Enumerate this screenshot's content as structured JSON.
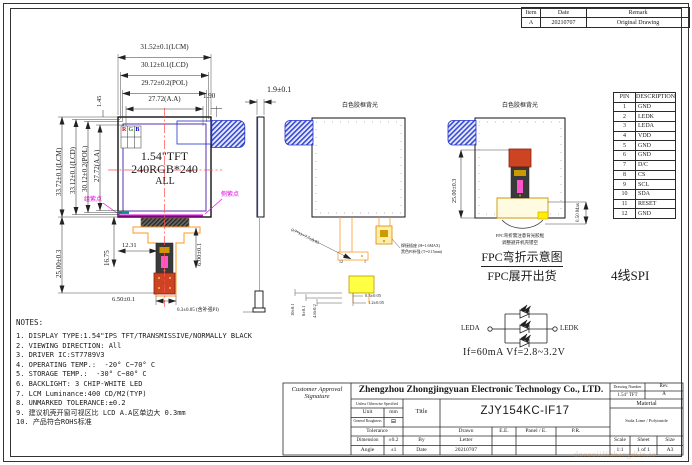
{
  "colors": {
    "centerline_red": "#ff5050",
    "fpc_orange": "#ff9922",
    "marker_magenta": "#e000e0",
    "tape_blue": "#2233cc",
    "stiffener_yellow": "#ffff44",
    "stiffener_red": "#cc4422",
    "pad_gold": "#cc9900",
    "aa_border_purple": "#5533aa"
  },
  "revision_table": {
    "headers": [
      "Item",
      "Date",
      "Remark"
    ],
    "row": [
      "A",
      "20210707",
      "Original Drawing"
    ]
  },
  "pin_table": {
    "headers": [
      "PIN",
      "DESCRIPTION"
    ],
    "rows": [
      [
        "1",
        "GND"
      ],
      [
        "2",
        "LEDK"
      ],
      [
        "3",
        "LEDA"
      ],
      [
        "4",
        "VDD"
      ],
      [
        "5",
        "GND"
      ],
      [
        "6",
        "GND"
      ],
      [
        "7",
        "D/C"
      ],
      [
        "8",
        "CS"
      ],
      [
        "9",
        "SCL"
      ],
      [
        "10",
        "SDA"
      ],
      [
        "11",
        "RESET"
      ],
      [
        "12",
        "GND"
      ]
    ]
  },
  "interface_label": "4线SPI",
  "front_view": {
    "dims_top": [
      "31.52±0.1(LCM)",
      "30.12±0.1(LCD)",
      "29.72±0.2(POL)",
      "27.72(A.A)"
    ],
    "dim_gap_tl": "1.45",
    "dim_gap_tr": "1.90",
    "dims_left": [
      "33.72±0.1(LCM)",
      "33.12±0.1(LCD)",
      "30.12±0.2(POL)",
      "27.72(A.A)"
    ],
    "dim_below_height": "25.00±0.3",
    "dim_tail_height": "16.75",
    "dim_offset": "12.31",
    "dim_tail_len": "6.00±0.1",
    "dim_tail_width": "6.50±0.1",
    "rgb": [
      "R",
      "G",
      "B"
    ],
    "panel_line1": "1.54\"TFT",
    "panel_line2": "240RGB*240",
    "panel_line3": "ALL",
    "purple_dot_left": "组紫点",
    "purple_dot_right": "侧紫点",
    "fpc_note": "0.3±0.05 (含补强PI)"
  },
  "side_view": {
    "dim_thickness": "1.9±0.1"
  },
  "back_view_open": {
    "backlight_label": "白色胶框背光",
    "diagonal_dim": "0.7*11=7.7±0.05",
    "pin_last": "12",
    "pin_first": "1",
    "dims_left": [
      "10±0.1",
      "8±0.1",
      "4.8±0.2"
    ],
    "dims_right": [
      "0.3±0.05",
      "1.2±0.05"
    ],
    "connector_note1": "焊接插座 (H=1.6MAX)",
    "connector_note2": "黑色PI补强 (T=0.15mm)"
  },
  "back_view_folded": {
    "backlight_label": "白色胶框背光",
    "dim_left": "25.00±0.3",
    "dim_right": "0.50 Max",
    "note1": "FPC弯折需注意背光胶框",
    "note2": "调整避开机壳镂空",
    "caption1": "FPC弯折示意图",
    "caption2": "FPC展开出货"
  },
  "led_circuit": {
    "anode": "LEDA",
    "cathode": "LEDK",
    "spec": "If=60mA  Vf=2.8~3.2V"
  },
  "notes": {
    "title": "NOTES:",
    "items": [
      "1. DISPLAY TYPE:1.54\"IPS TFT/TRANSMISSIVE/NORMALLY BLACK",
      "2. VIEWING DIRECTION: All",
      "3. DRIVER IC:ST7789V3",
      "4. OPERATING TEMP.:  -20° C~70° C",
      "5. STORAGE TEMP.:  -30° C~80° C",
      "6. BACKLIGHT: 3 CHIP-WHITE LED",
      "7. LCM Luminance:400 CD/M2(TYP)",
      "8. UNMARKED TOLERANCE:±0.2",
      "9. 建议机壳开窗可视区比 LCD A.A区单边大 0.3mm",
      "10. 产品符合ROHS标准"
    ]
  },
  "title_block": {
    "customer": "Customer Approval Signature",
    "company": "Zhengzhou Zhongjingyuan Electronic Technology Co., LTD.",
    "drawing_number_label": "Drawing Number",
    "drawing_number": "1.54\" TFT",
    "rev_label": "Rev.",
    "rev": "A",
    "unless": "Unless Otherwise Specified",
    "unit_label": "Unit",
    "unit": "mm",
    "roughness_label": "General Roughness",
    "roughness_symbol": "⊟",
    "title_label": "Title",
    "title": "ZJY154KC-IF17",
    "tolerance_label": "Tolerance",
    "drawn_label": "Drawn",
    "ee_label": "E.E.",
    "panel_label": "Panel / E.",
    "pr_label": "P.R.",
    "dimension_label": "Dimension",
    "dimension_tol": "±0.2",
    "by_label": "By",
    "by": "Letter",
    "angle_label": "Angle",
    "angle_tol": "±1",
    "date_label": "Date",
    "date": "20210707",
    "material_label": "Material",
    "material": "Soda Lime / Polyimide",
    "scale_label": "Scale",
    "scale": "1:1",
    "sheet_label": "Sheet",
    "sheet": "1 of 1",
    "size_label": "Size",
    "size": "A3"
  },
  "watermark": "dooooiif6zhangdOo.to"
}
